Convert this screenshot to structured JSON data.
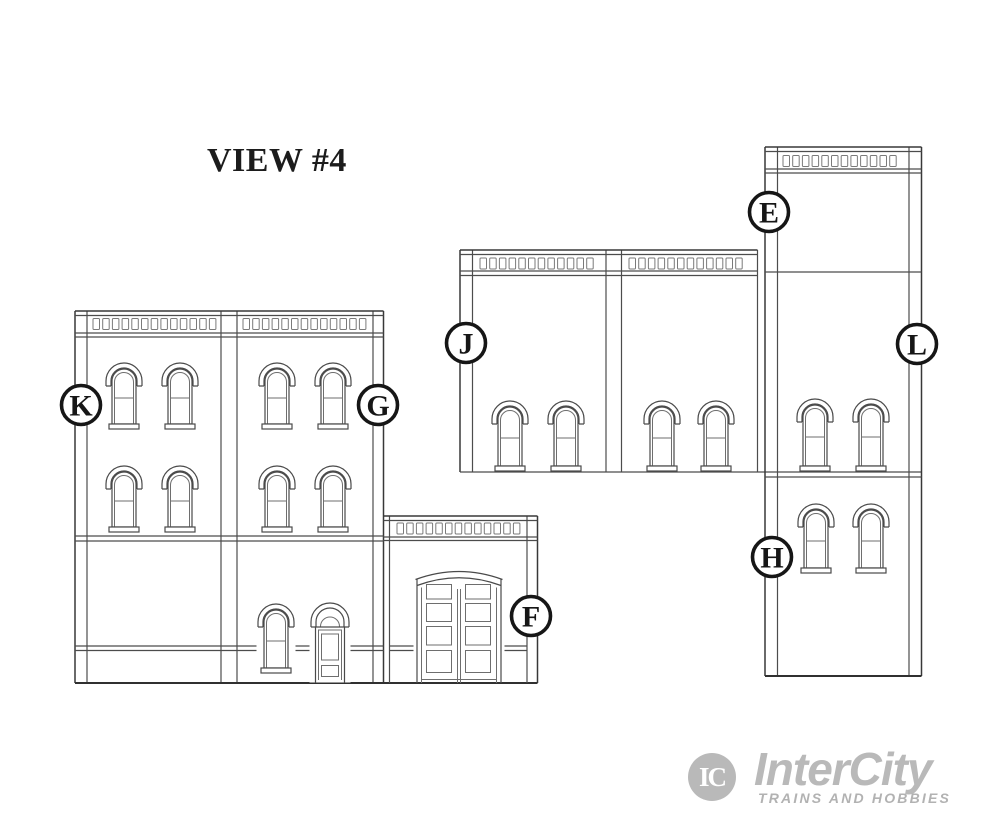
{
  "title": "VIEW #4",
  "diagram": {
    "description": "Model building kit wall elevation diagram, view 4",
    "part_labels": [
      {
        "letter": "E"
      },
      {
        "letter": "F"
      },
      {
        "letter": "G"
      },
      {
        "letter": "H"
      },
      {
        "letter": "J"
      },
      {
        "letter": "K"
      },
      {
        "letter": "L"
      }
    ]
  },
  "logo": {
    "monogram": "IC",
    "brand": "InterCity",
    "tagline": "TRAINS AND HOBBIES",
    "color": "#b9b9b9"
  },
  "colors": {
    "background": "#ffffff",
    "line": "#4c4c4c",
    "label_ink": "#161616"
  }
}
